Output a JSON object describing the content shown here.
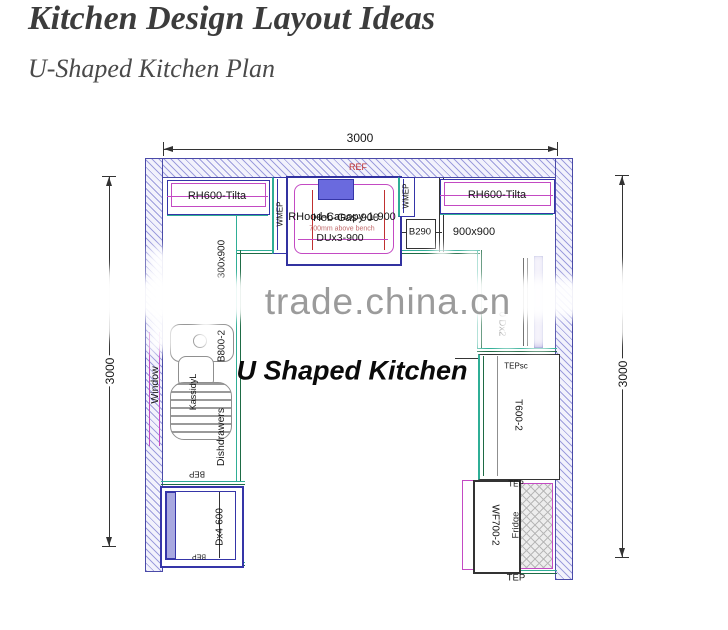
{
  "header": {
    "title": "Kitchen Design Layout Ideas",
    "subtitle": "U-Shaped Kitchen Plan"
  },
  "watermark": {
    "text": "trade.china.cn"
  },
  "plan": {
    "title_label": "U Shaped Kitchen",
    "dims": {
      "top": "3000",
      "left": "3000",
      "right": "3000"
    },
    "labels": {
      "ref": "REF",
      "rh_left": "RH600-Tilta",
      "rh_right": "RH600-Tilta",
      "wmep_left": "WMEP",
      "wmep_right": "WMEP",
      "canopy": "RHood-Canopy-1-900",
      "hob": "Hob-Gas-900",
      "canopy_note": "700mm above bench",
      "du": "DUx3-900",
      "b290": "B290",
      "corner_right": "900x900",
      "corner_left": "300x900",
      "window": "Window",
      "sink_cab": "B800-2",
      "sink_brand": "KassidyL",
      "dishdrawers": "Dishdrawers",
      "bep_top": "BEP",
      "oven": "Dx4-600",
      "bep_bottom": "BEP",
      "dx2": "0 Dx2",
      "tepsc": "TEPsc",
      "pantry": "T600-2",
      "tep_top": "TEP",
      "fridge_unit": "WF700-2",
      "fridge": "Fridge",
      "tep_bottom": "TEP"
    },
    "colors": {
      "wall": "#4a4aa8",
      "hatch": "#8a8ad2",
      "magenta": "#c34ac3",
      "teal": "#2fae96",
      "green": "#1e6b45",
      "blue": "#3535a8",
      "red": "#c03030",
      "hood": "#6a6ade",
      "watermark": "#9b9b9b"
    }
  }
}
